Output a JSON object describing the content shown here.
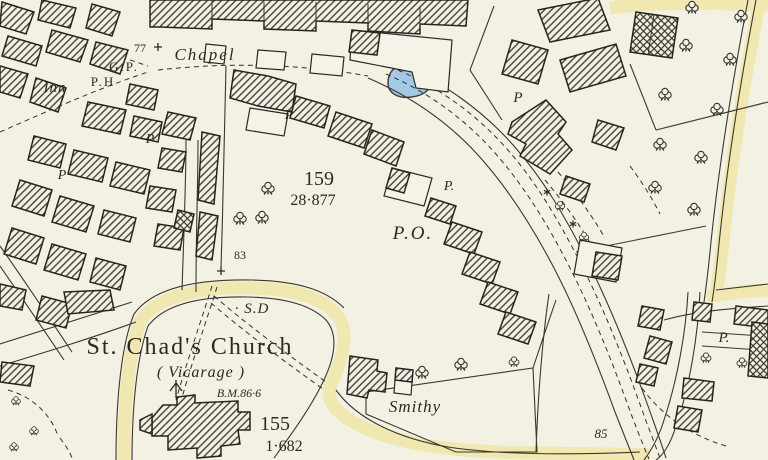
{
  "map": {
    "style": "historic Ordnance Survey 25-inch town plan extract",
    "colors": {
      "paper": "#f3f0e4",
      "ink": "#2c2a24",
      "road_tint_yellow": "#f0e8b0",
      "pond_fill": "#a4c9e4",
      "pond_edge": "#43413a"
    },
    "labels": {
      "bench_height_77": "77",
      "chapel": "Chapel",
      "guide_post": "G.P.",
      "inn": "Inn",
      "public_house": "P.H",
      "pump_center": "P",
      "pump_left_upper": "P",
      "pump_left_lower": "P",
      "pump_near_po": "P.",
      "pump_right_upper": "P",
      "pump_bottom_right": "P.",
      "parcel_159_number": "159",
      "parcel_159_area": "28·877",
      "post_office": "P.O.",
      "parcel_83_number": "83",
      "sundial": "· S.D",
      "church_name": "St. Chad's Church",
      "vicarage": "( Vicarage )",
      "benchmark": "B.M.86·6",
      "parcel_155_number": "155",
      "parcel_155_area": "1·682",
      "smithy": "Smithy",
      "parcel_85_number": "85"
    }
  }
}
